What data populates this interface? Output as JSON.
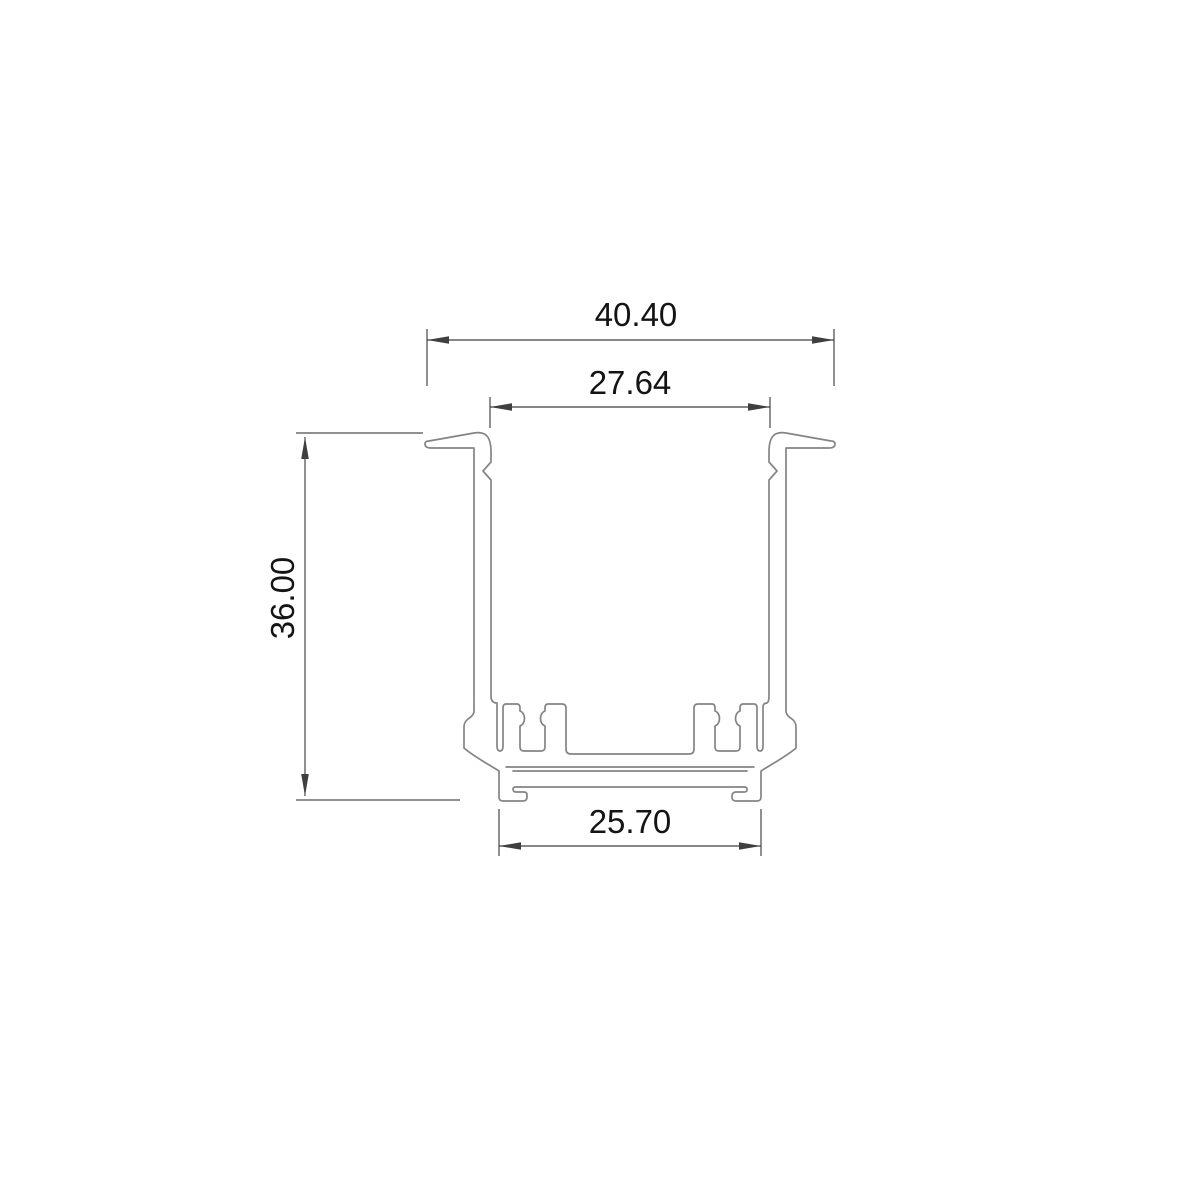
{
  "drawing": {
    "title": "aluminum-led-profile-cross-section",
    "colors": {
      "background": "#ffffff",
      "profile_line": "#848484",
      "dimension_line": "#3f3f3f",
      "extension_line_gray": "#8f8f8f",
      "text": "#141414"
    },
    "dimensions": {
      "top_width": {
        "value": "40.40",
        "orientation": "horizontal"
      },
      "inner_width": {
        "value": "27.64",
        "orientation": "horizontal"
      },
      "height": {
        "value": "36.00",
        "orientation": "vertical"
      },
      "bottom_width": {
        "value": "25.70",
        "orientation": "horizontal"
      }
    }
  }
}
